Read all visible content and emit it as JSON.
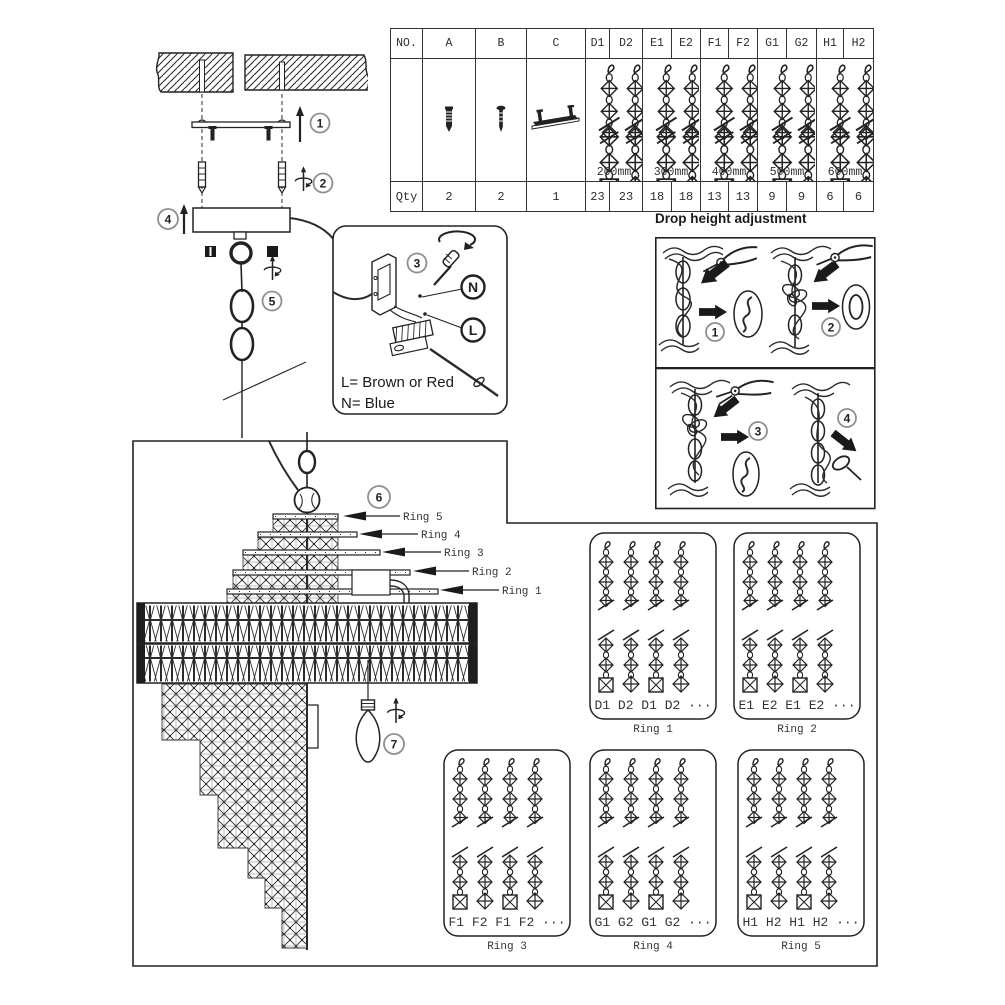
{
  "parts_table": {
    "headers": [
      "NO.",
      "A",
      "B",
      "C",
      "D1",
      "D2",
      "E1",
      "E2",
      "F1",
      "F2",
      "G1",
      "G2",
      "H1",
      "H2"
    ],
    "lengths": [
      "200mm",
      "300mm",
      "400mm",
      "500mm",
      "600mm"
    ],
    "qty_label": "Qty",
    "qty_values": [
      "2",
      "2",
      "1",
      "23",
      "23",
      "18",
      "18",
      "13",
      "13",
      "9",
      "9",
      "6",
      "6"
    ]
  },
  "install": {
    "step1": "1",
    "step2": "2",
    "step4": "4",
    "step5": "5"
  },
  "wiring": {
    "step3": "3",
    "n_label": "N",
    "l_label": "L",
    "line1": "L=  Brown or Red",
    "line2": "N=  Blue"
  },
  "drop_adjust": {
    "title": "Drop height adjustment",
    "step1": "1",
    "step2": "2",
    "step3": "3",
    "step4": "4"
  },
  "chandelier": {
    "step6": "6",
    "step7": "7",
    "ring_pointers": [
      "Ring 5",
      "Ring 4",
      "Ring 3",
      "Ring 2",
      "Ring 1"
    ]
  },
  "ring_boxes": [
    {
      "sequence": "D1 D2 D1 D2 ···",
      "caption": "Ring 1"
    },
    {
      "sequence": "E1 E2 E1 E2 ···",
      "caption": "Ring 2"
    },
    {
      "sequence": "F1 F2 F1 F2 ···",
      "caption": "Ring 3"
    },
    {
      "sequence": "G1 G2 G1 G2 ···",
      "caption": "Ring 4"
    },
    {
      "sequence": "H1 H2 H1 H2 ···",
      "caption": "Ring 5"
    }
  ],
  "colors": {
    "line": "#2b2b2b",
    "badge_ring": "#8f8f8f",
    "arrow": "#1a1a1a"
  }
}
